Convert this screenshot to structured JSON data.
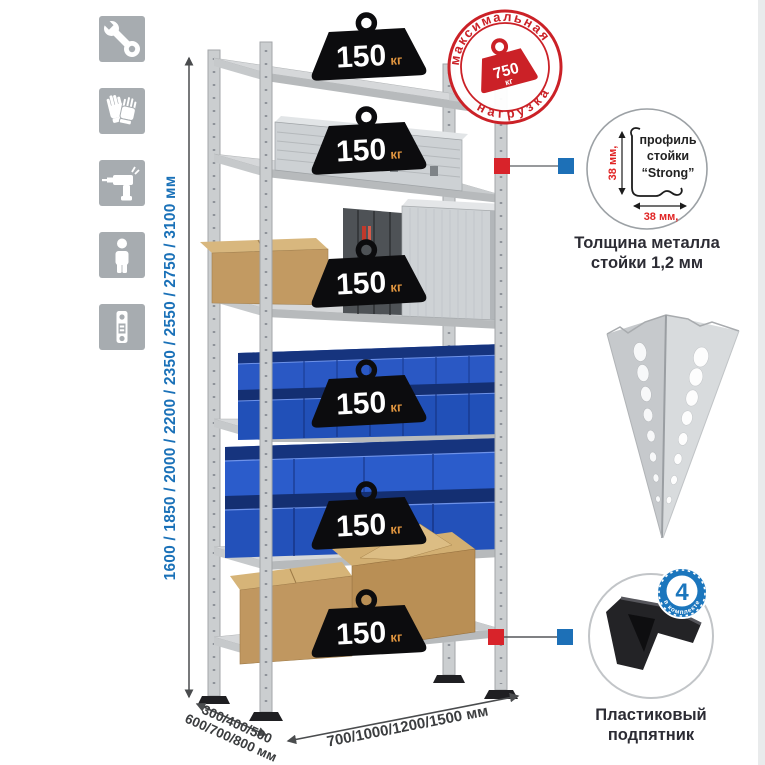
{
  "page": {
    "background": "#ffffff"
  },
  "colors": {
    "accent_red": "#cb2127",
    "accent_blue": "#1d70b7",
    "dimension_blue": "#1a71b8",
    "badge_black": "#0c0c0e",
    "kg_orange": "#e0953f",
    "bin_blue": "#2a58c4",
    "metal_gray": "#cbced0"
  },
  "left_icons": [
    {
      "name": "wrench-icon"
    },
    {
      "name": "gloves-icon"
    },
    {
      "name": "drill-icon"
    },
    {
      "name": "person-icon"
    },
    {
      "name": "rack-post-icon"
    }
  ],
  "dimensions": {
    "height_label": "1600 / 1850 / 2000 / 2200 / 2350 / 2550 / 2750 / 3100 мм",
    "depth_label_line1": "300/400/500",
    "depth_label_line2": "600/700/800 мм",
    "width_label": "700/1000/1200/1500 мм"
  },
  "shelves": [
    {
      "capacity": "150",
      "unit": "кг"
    },
    {
      "capacity": "150",
      "unit": "кг"
    },
    {
      "capacity": "150",
      "unit": "кг"
    },
    {
      "capacity": "150",
      "unit": "кг"
    },
    {
      "capacity": "150",
      "unit": "кг"
    },
    {
      "capacity": "150",
      "unit": "кг"
    }
  ],
  "max_load_stamp": {
    "arc_top": "максимальная",
    "arc_bottom": "нагрузка",
    "value": "750",
    "unit": "кг"
  },
  "profile_detail": {
    "label_line1": "профиль",
    "label_line2": "стойки",
    "label_line3": "“Strong”",
    "vertical_dim": "38 мм,",
    "horizontal_dim": "38 мм,",
    "caption_line1": "Толщина металла",
    "caption_line2": "стойки 1,2 мм"
  },
  "foot_detail": {
    "badge_count": "4",
    "badge_label": "в комплекте",
    "caption_line1": "Пластиковый",
    "caption_line2": "подпятник"
  }
}
